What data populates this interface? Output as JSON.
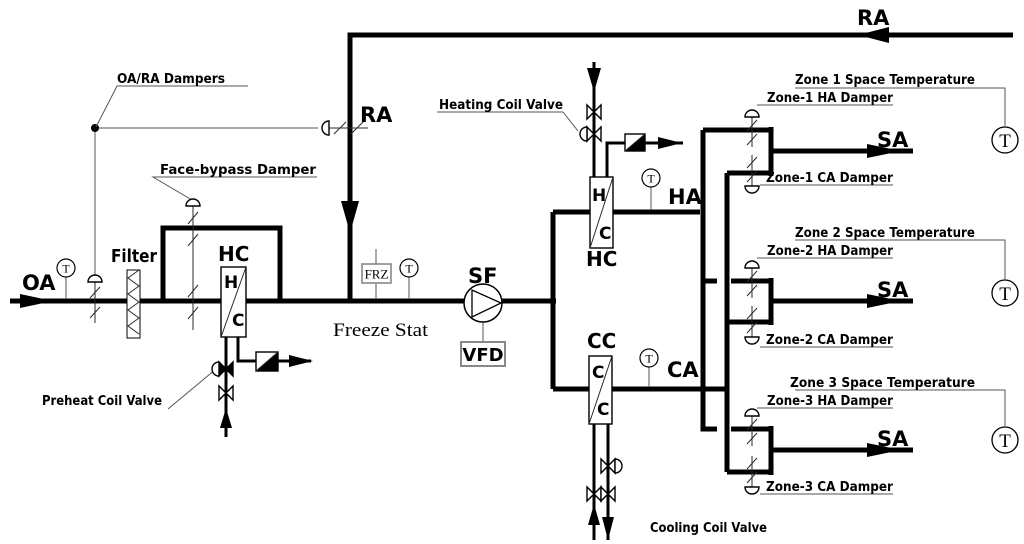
{
  "labels": {
    "oa": "OA",
    "ra_top": "RA",
    "ra_vertical": "RA",
    "ha": "HA",
    "ca": "CA",
    "sf": "SF",
    "vfd": "VFD",
    "frz": "FRZ",
    "freeze_stat": "Freeze Stat",
    "filter": "Filter",
    "preheat_coil": "HC",
    "heating_coil": "HC",
    "cooling_coil": "CC",
    "oa_ra_dampers": "OA/RA Dampers",
    "face_bypass_damper": "Face-bypass Damper",
    "preheat_coil_valve": "Preheat Coil Valve",
    "heating_coil_valve": "Heating Coil Valve",
    "cooling_coil_valve": "Cooling Coil Valve"
  },
  "coil_letters": {
    "preheat_top": "H",
    "preheat_bottom": "C",
    "heating_top": "H",
    "heating_bottom": "C",
    "cooling_top": "C",
    "cooling_bottom": "C"
  },
  "sensor_letter": "T",
  "zones": [
    {
      "space_temperature": "Zone 1 Space Temperature",
      "ha_damper": "Zone-1 HA Damper",
      "ca_damper": "Zone-1 CA Damper",
      "sa": "SA"
    },
    {
      "space_temperature": "Zone 2 Space Temperature",
      "ha_damper": "Zone-2 HA Damper",
      "ca_damper": "Zone-2 CA Damper",
      "sa": "SA"
    },
    {
      "space_temperature": "Zone 3 Space Temperature",
      "ha_damper": "Zone-3 HA Damper",
      "ca_damper": "Zone-3 CA Damper",
      "sa": "SA"
    }
  ],
  "colors": {
    "line": "#000000",
    "background": "#ffffff",
    "thin_line": "#333333",
    "box_border": "#888888"
  }
}
